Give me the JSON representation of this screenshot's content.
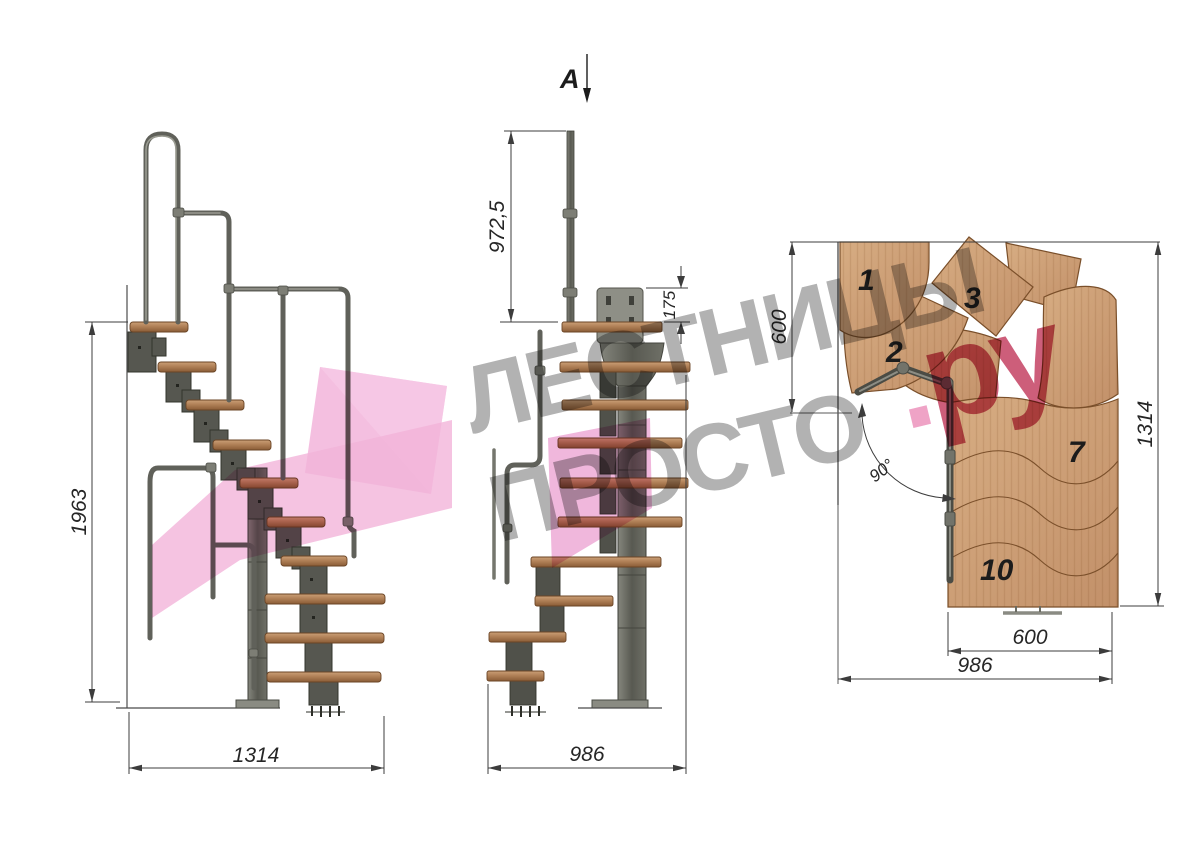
{
  "drawing": {
    "side_view": {
      "label_height": "1963",
      "label_width": "1314"
    },
    "front_view": {
      "section_mark": "A",
      "label_rail_height": "972,5",
      "label_plate": "175",
      "label_width": "986"
    },
    "plan_view": {
      "label_depth": "600",
      "label_total": "1314",
      "label_tread": "600",
      "label_width": "986",
      "label_angle": "90°",
      "numbers": {
        "n1": "1",
        "n2": "2",
        "n3": "3",
        "n7": "7",
        "n10": "10"
      }
    }
  },
  "watermark": {
    "line1": "ЛЕСТНИЦЫ",
    "line2": "ПРОСТО",
    "dot": ".",
    "tld": "ру"
  },
  "colors": {
    "wood": "#b08057",
    "plan_wood": "#cda075",
    "steel": "#5a5b52",
    "logo_pink": "#f2b4da",
    "brand_crimson": "#c13a5c",
    "watermark_gray": "#b2b2b2",
    "dim_line": "#3c3c3c"
  }
}
